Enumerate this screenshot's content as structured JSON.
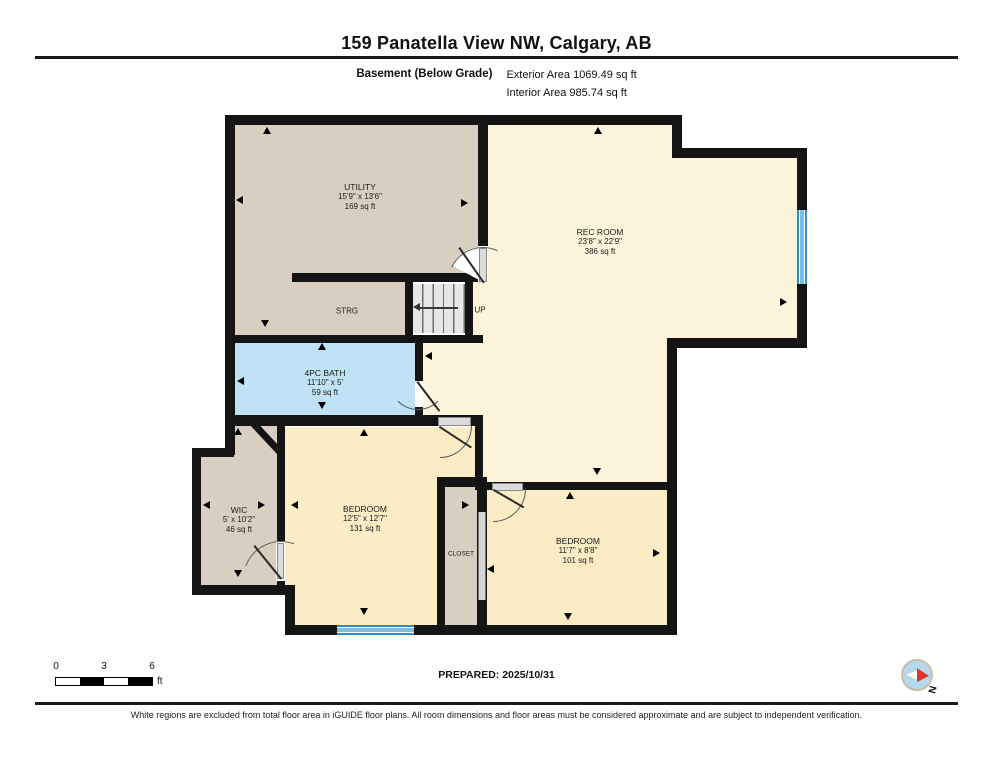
{
  "header": {
    "title": "159 Panatella View NW, Calgary, AB",
    "floor_label": "Basement (Below Grade)",
    "exterior_area": "Exterior Area 1069.49 sq ft",
    "interior_area": "Interior Area 985.74 sq ft"
  },
  "rooms": [
    {
      "name": "UTILITY",
      "dims": "15'9\" x 13'6\"",
      "area": "169 sq ft"
    },
    {
      "name": "STRG"
    },
    {
      "name": "REC ROOM",
      "dims": "23'8\" x 22'9\"",
      "area": "386 sq ft"
    },
    {
      "name": "4PC BATH",
      "dims": "11'10\" x 5'",
      "area": "59 sq ft"
    },
    {
      "name": "WIC",
      "dims": "5' x 10'2\"",
      "area": "46 sq ft"
    },
    {
      "name": "BEDROOM",
      "dims": "12'5\" x 12'7\"",
      "area": "131 sq ft"
    },
    {
      "name": "CLOSET"
    },
    {
      "name": "BEDROOM",
      "dims": "11'7\" x 8'8\"",
      "area": "101 sq ft"
    }
  ],
  "stairs": {
    "label": "UP"
  },
  "footer": {
    "scale": {
      "ticks": [
        "0",
        "3",
        "6"
      ],
      "unit": "ft"
    },
    "prepared": "PREPARED: 2025/10/31",
    "compass_label": "N",
    "disclaimer": "White regions are excluded from total floor area in iGUIDE floor plans. All room dimensions and floor areas must be considered approximate and are subject to independent verification."
  },
  "colors": {
    "wall": "#141414",
    "rec_room_fill": "#fbf3da",
    "bedroom_fill": "#faecc4",
    "utility_fill": "#d9cfc1",
    "bath_fill": "#bfe2f4",
    "window_blue": "#2e8fc2",
    "window_blue_light": "#77c0e6",
    "door_gray": "#dcdcdc",
    "compass_blue": "#b5d8ec",
    "compass_red": "#e0342f"
  }
}
